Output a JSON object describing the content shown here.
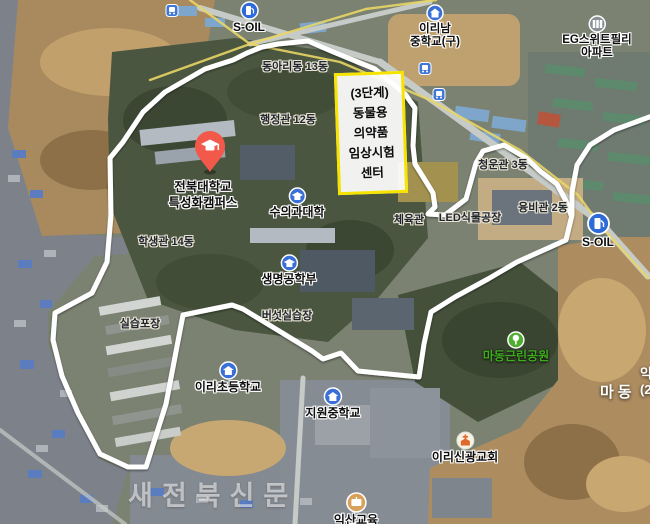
{
  "watermark": "새전북신문",
  "highlight_box": {
    "border_color": "#f6e400",
    "line1": "(3단계)",
    "line2": "동물용",
    "line3": "의약품",
    "line4": "임상시험",
    "line5": "센터"
  },
  "main_pin": {
    "color": "#f2594b",
    "line1": "전북대학교",
    "line2": "특성화캠퍼스"
  },
  "pois": {
    "soil_top": {
      "label": "S-OIL"
    },
    "soil_right": {
      "label": "S-OIL"
    },
    "irinam_school": {
      "line1": "이리남",
      "line2": "중학교(구)"
    },
    "eg_apartment": {
      "line1": "EG스위트필리",
      "line2": "아파트"
    },
    "vet_college": {
      "label": "수의과대학"
    },
    "biotech": {
      "label": "생명공학부"
    },
    "iri_elementary": {
      "label": "이리초등학교"
    },
    "jiwon_middle": {
      "label": "지원중학교"
    },
    "madong_park": {
      "label": "마동근린공원",
      "label_color": "#3fae1e"
    },
    "shingwang_church": {
      "label": "이리신광교회"
    },
    "iksan_edu": {
      "label": "익산교육"
    }
  },
  "building_labels": {
    "dongari": "동아리동 13동",
    "haengjeong": "행정관 12동",
    "haksaeng": "학생관 14동",
    "cheyukgwan": "체육관",
    "led_factory": "LED식물공장",
    "cheongun": "청운관 3동",
    "yungbi": "융비관 2동",
    "mushroom": "버섯실습장",
    "silseup": "실습포장"
  },
  "area_labels": {
    "madong": "마동",
    "edge_cut_top": "익",
    "edge_cut_bottom": "(2"
  },
  "boundary": {
    "color": "#ffffff",
    "width": 5,
    "points": [
      [
        652,
        116
      ],
      [
        614,
        130
      ],
      [
        590,
        145
      ],
      [
        577,
        165
      ],
      [
        572,
        192
      ],
      [
        572,
        215
      ],
      [
        566,
        240
      ],
      [
        517,
        262
      ],
      [
        488,
        279
      ],
      [
        455,
        297
      ],
      [
        431,
        312
      ],
      [
        424,
        344
      ],
      [
        419,
        377
      ],
      [
        358,
        371
      ],
      [
        341,
        353
      ],
      [
        323,
        359
      ],
      [
        312,
        351
      ],
      [
        243,
        309
      ],
      [
        232,
        305
      ],
      [
        183,
        315
      ],
      [
        166,
        404
      ],
      [
        146,
        467
      ],
      [
        128,
        467
      ],
      [
        100,
        454
      ],
      [
        78,
        413
      ],
      [
        62,
        376
      ],
      [
        53,
        340
      ],
      [
        55,
        313
      ],
      [
        92,
        293
      ],
      [
        107,
        262
      ],
      [
        111,
        215
      ],
      [
        110,
        158
      ],
      [
        123,
        142
      ],
      [
        143,
        112
      ],
      [
        165,
        92
      ],
      [
        205,
        69
      ],
      [
        233,
        60
      ],
      [
        247,
        53
      ],
      [
        262,
        47
      ],
      [
        278,
        44
      ],
      [
        308,
        41
      ],
      [
        331,
        51
      ],
      [
        375,
        69
      ],
      [
        405,
        94
      ],
      [
        415,
        108
      ],
      [
        413,
        146
      ],
      [
        415,
        164
      ],
      [
        425,
        180
      ],
      [
        433,
        193
      ],
      [
        435,
        207
      ],
      [
        428,
        214
      ],
      [
        445,
        215
      ],
      [
        466,
        199
      ],
      [
        476,
        163
      ],
      [
        483,
        151
      ],
      [
        504,
        145
      ],
      [
        526,
        158
      ],
      [
        540,
        171
      ],
      [
        557,
        184
      ],
      [
        566,
        201
      ],
      [
        571,
        215
      ]
    ]
  },
  "roads": {
    "color": "#e8d565",
    "road_a": [
      [
        190,
        0
      ],
      [
        250,
        44
      ],
      [
        340,
        62
      ],
      [
        430,
        100
      ],
      [
        520,
        150
      ],
      [
        578,
        195
      ],
      [
        600,
        225
      ],
      [
        648,
        278
      ]
    ],
    "road_b": [
      [
        150,
        80
      ],
      [
        250,
        44
      ],
      [
        366,
        9
      ],
      [
        436,
        0
      ]
    ]
  }
}
